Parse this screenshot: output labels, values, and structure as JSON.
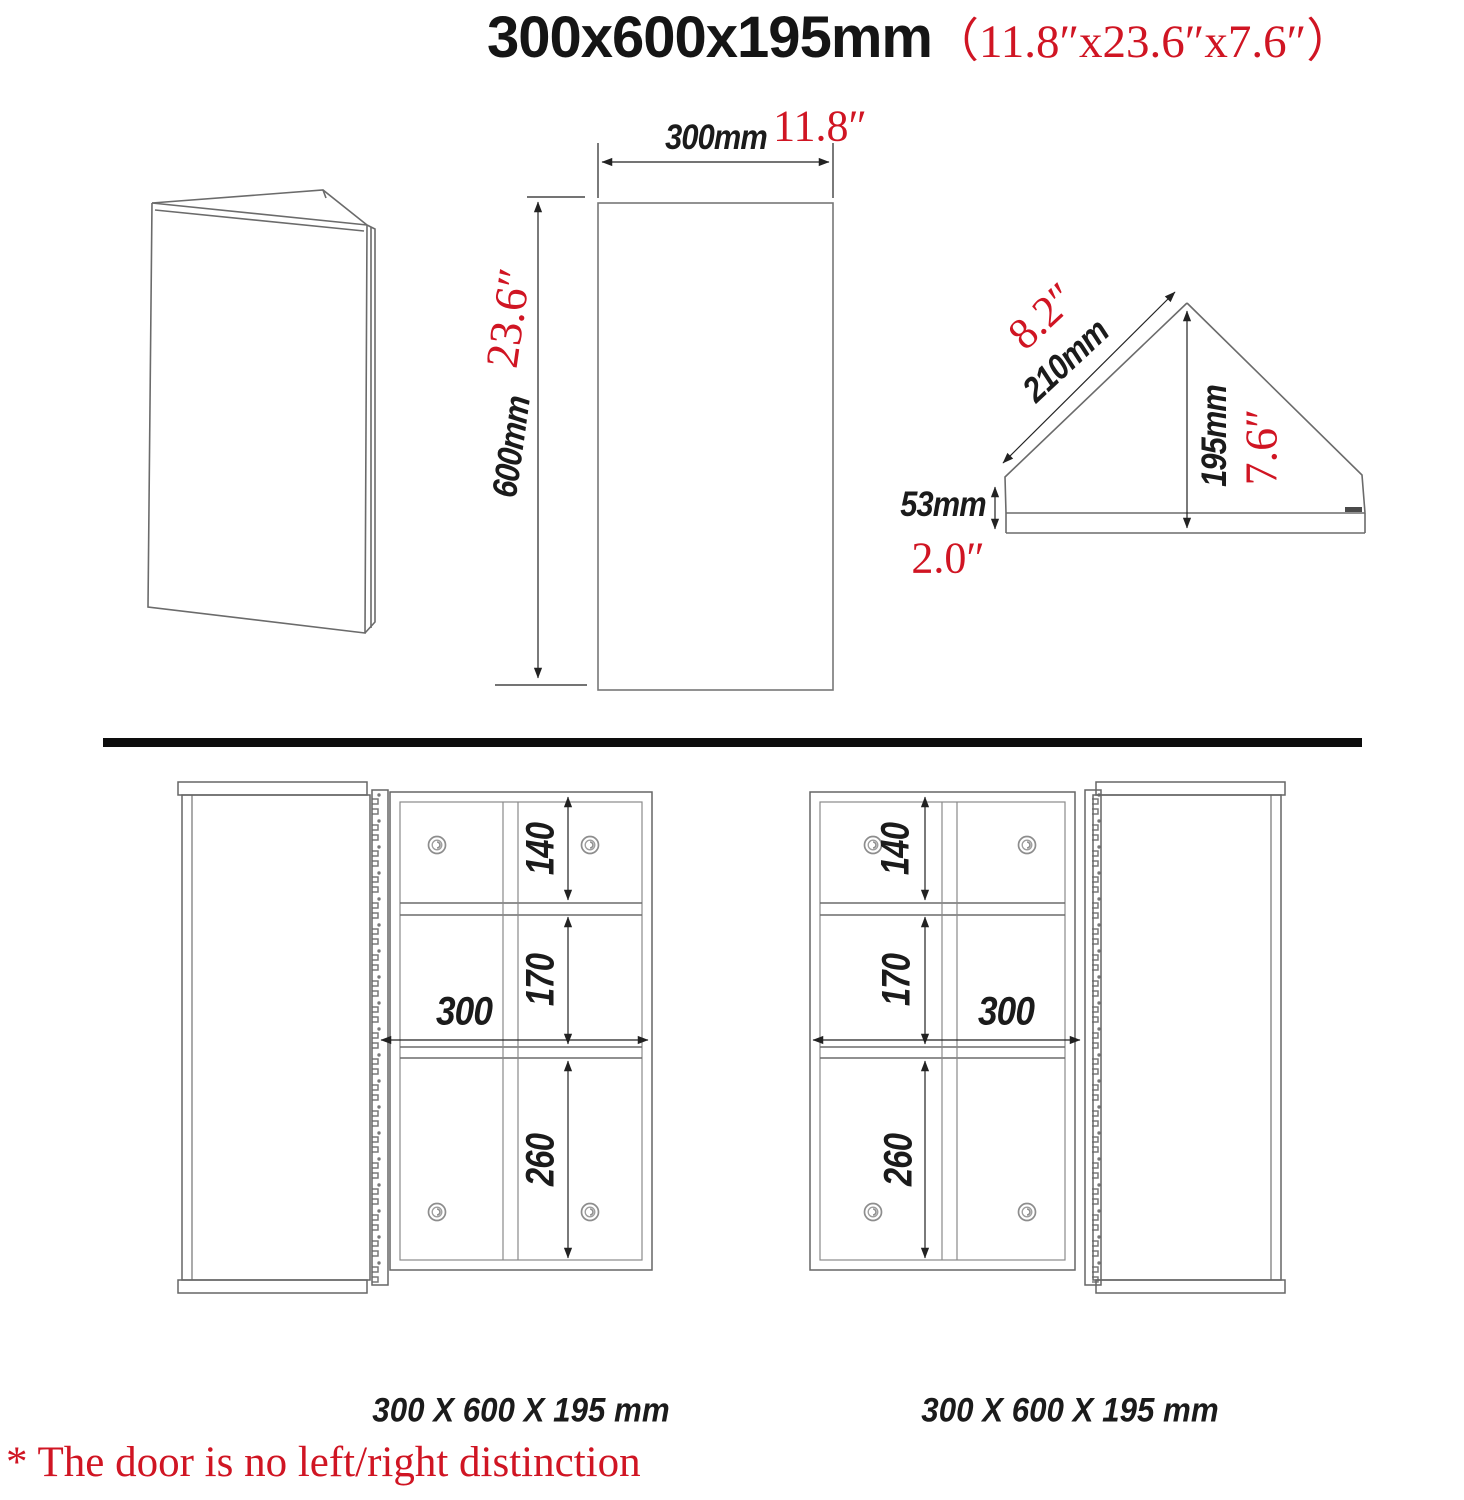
{
  "title": {
    "size_metric": "300x600x195mm",
    "size_imperial": "（11.8″x23.6″x7.6″）"
  },
  "front_view": {
    "width_mm": "300mm",
    "width_in": "11.8″",
    "height_mm": "600mm",
    "height_in": "23.6″"
  },
  "top_view": {
    "slope_mm": "210mm",
    "slope_in": "8.2″",
    "depth_mm": "195mm",
    "depth_in": "7.6″",
    "front_mm": "53mm",
    "front_in": "2.0″"
  },
  "open_view_left": {
    "compartment_top": "140",
    "compartment_middle": "170",
    "compartment_bottom": "260",
    "inner_width": "300",
    "caption": "300 X 600 X 195 mm"
  },
  "open_view_right": {
    "compartment_top": "140",
    "compartment_middle": "170",
    "compartment_bottom": "260",
    "inner_width": "300",
    "caption": "300 X 600 X 195 mm"
  },
  "note": "* The door is no left/right distinction",
  "colors": {
    "accent_red": "#d01523",
    "drawing_gray": "#6b6b6b",
    "dimension_black": "#222222"
  }
}
